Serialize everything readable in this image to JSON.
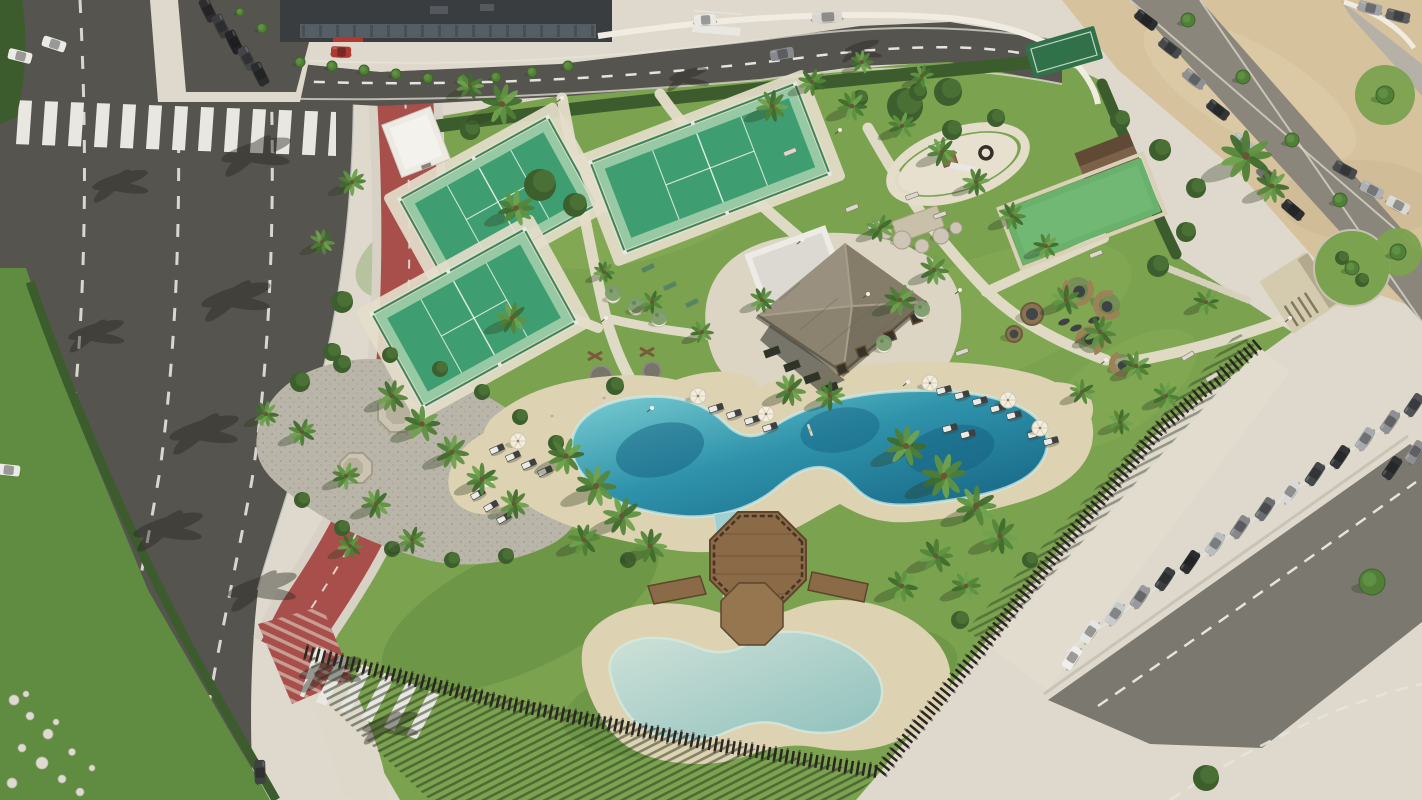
{
  "scene": {
    "description": "Aerial rendering of a fenced resort amenity park: free-form lagoon pool with sand beach and kids pool, octagonal timber deck, thatched-roof pavilion with white annex, three padel courts, playground, petanque court, wicker seating pods, palm landscaping; curved multi-lane road with red bike lane on the left, parking lots on top and right, sand esplanade top-right."
  },
  "palette": {
    "road": "#56544e",
    "roadLight": "#8a867c",
    "parking": "#7b786f",
    "marking": "#e6e4de",
    "bike": "#a84f4c",
    "concrete": "#ded9cc",
    "path": "#e4ddca",
    "beach": "#ddd2b2",
    "sand": "#d6c29d",
    "lawn": "#7ba24f",
    "lawnDark": "#5f8c40",
    "hedge": "#3d5c2e",
    "poolDeep": "#135f80",
    "poolMid": "#2f93ab",
    "poolLight": "#7fd0d4",
    "poolPale": "#abd1cb",
    "poolRim": "#cfe9e4",
    "wood": "#8a6a47",
    "woodDark": "#5e462c",
    "thatch": "#8d8471",
    "fence": "#2b2622",
    "building": "#3a3d40",
    "courtGreen": "#3f9e71",
    "courtLight": "#97c9a5",
    "courtFence": "#2f7a50",
    "white": "#efece4"
  },
  "objects": {
    "courts": [
      {
        "x": 498,
        "y": 202,
        "w": 165,
        "h": 96,
        "a": -29,
        "kind": "padel"
      },
      {
        "x": 474,
        "y": 318,
        "w": 170,
        "h": 102,
        "a": -29,
        "kind": "padel"
      },
      {
        "x": 710,
        "y": 168,
        "w": 215,
        "h": 92,
        "a": -21,
        "kind": "padel"
      },
      {
        "x": 1082,
        "y": 211,
        "w": 148,
        "h": 58,
        "a": -21,
        "kind": "turf"
      },
      {
        "x": 1064,
        "y": 52,
        "w": 72,
        "h": 34,
        "a": -16,
        "kind": "mini"
      }
    ],
    "palms": [
      [
        502,
        104,
        19
      ],
      [
        516,
        208,
        17
      ],
      [
        512,
        318,
        15
      ],
      [
        470,
        86,
        13
      ],
      [
        392,
        396,
        15
      ],
      [
        422,
        424,
        17
      ],
      [
        452,
        452,
        16
      ],
      [
        482,
        479,
        15
      ],
      [
        514,
        504,
        14
      ],
      [
        302,
        432,
        13
      ],
      [
        266,
        414,
        12
      ],
      [
        346,
        476,
        13
      ],
      [
        376,
        504,
        14
      ],
      [
        412,
        540,
        13
      ],
      [
        350,
        546,
        12
      ],
      [
        566,
        456,
        17
      ],
      [
        596,
        486,
        19
      ],
      [
        622,
        516,
        18
      ],
      [
        650,
        546,
        16
      ],
      [
        584,
        540,
        15
      ],
      [
        906,
        446,
        19
      ],
      [
        944,
        476,
        21
      ],
      [
        976,
        506,
        19
      ],
      [
        1000,
        536,
        17
      ],
      [
        936,
        556,
        16
      ],
      [
        902,
        586,
        15
      ],
      [
        966,
        586,
        14
      ],
      [
        790,
        390,
        15
      ],
      [
        830,
        396,
        14
      ],
      [
        762,
        300,
        12
      ],
      [
        900,
        300,
        15
      ],
      [
        934,
        270,
        14
      ],
      [
        880,
        228,
        13
      ],
      [
        772,
        106,
        15
      ],
      [
        812,
        82,
        13
      ],
      [
        852,
        106,
        14
      ],
      [
        902,
        126,
        13
      ],
      [
        942,
        152,
        14
      ],
      [
        976,
        182,
        13
      ],
      [
        1012,
        216,
        13
      ],
      [
        1046,
        246,
        12
      ],
      [
        862,
        62,
        11
      ],
      [
        922,
        76,
        11
      ],
      [
        1066,
        300,
        14
      ],
      [
        1100,
        332,
        15
      ],
      [
        1136,
        366,
        14
      ],
      [
        1166,
        396,
        13
      ],
      [
        1082,
        392,
        12
      ],
      [
        1120,
        422,
        12
      ],
      [
        1246,
        156,
        24
      ],
      [
        1272,
        186,
        16
      ],
      [
        352,
        182,
        13
      ],
      [
        322,
        242,
        12
      ],
      [
        652,
        302,
        11
      ],
      [
        604,
        272,
        10
      ],
      [
        1206,
        302,
        12
      ],
      [
        702,
        332,
        11
      ]
    ],
    "shrubs": [
      [
        540,
        185,
        16
      ],
      [
        575,
        205,
        12
      ],
      [
        905,
        106,
        18
      ],
      [
        948,
        92,
        14
      ],
      [
        615,
        386,
        9
      ],
      [
        1206,
        778,
        13
      ],
      [
        470,
        130,
        10
      ],
      [
        1158,
        266,
        11
      ],
      [
        1186,
        232,
        10
      ],
      [
        342,
        302,
        11
      ],
      [
        332,
        352,
        9
      ],
      [
        1342,
        258,
        7
      ],
      [
        1362,
        280,
        7
      ],
      [
        952,
        130,
        10
      ],
      [
        996,
        118,
        9
      ],
      [
        918,
        92,
        9
      ],
      [
        860,
        98,
        8
      ],
      [
        1120,
        120,
        10
      ],
      [
        1160,
        150,
        11
      ],
      [
        1196,
        188,
        10
      ],
      [
        300,
        382,
        10
      ],
      [
        342,
        364,
        9
      ],
      [
        390,
        355,
        8
      ],
      [
        440,
        369,
        8
      ],
      [
        482,
        392,
        8
      ],
      [
        520,
        417,
        8
      ],
      [
        556,
        443,
        8
      ],
      [
        302,
        500,
        8
      ],
      [
        342,
        528,
        8
      ],
      [
        392,
        549,
        8
      ],
      [
        452,
        560,
        8
      ],
      [
        506,
        556,
        8
      ],
      [
        628,
        560,
        8
      ],
      [
        960,
        620,
        9
      ],
      [
        1030,
        560,
        8
      ]
    ],
    "trees": [
      [
        300,
        62,
        5
      ],
      [
        332,
        66,
        5
      ],
      [
        364,
        70,
        5
      ],
      [
        396,
        74,
        5
      ],
      [
        428,
        78,
        5
      ],
      [
        462,
        80,
        5
      ],
      [
        496,
        77,
        5
      ],
      [
        532,
        72,
        5
      ],
      [
        568,
        66,
        5
      ],
      [
        262,
        28,
        5
      ],
      [
        240,
        12,
        4
      ],
      [
        1188,
        20,
        7
      ],
      [
        1243,
        77,
        7
      ],
      [
        1292,
        140,
        7
      ],
      [
        1340,
        200,
        7
      ],
      [
        1385,
        95,
        9
      ],
      [
        1398,
        252,
        8
      ],
      [
        1372,
        582,
        13
      ],
      [
        1352,
        268,
        7
      ]
    ],
    "cars": [
      {
        "x": 208,
        "y": 10,
        "a": 64,
        "c": "#2e2e30"
      },
      {
        "x": 221,
        "y": 26,
        "a": 64,
        "c": "#3a3c3e"
      },
      {
        "x": 234,
        "y": 42,
        "a": 64,
        "c": "#232426"
      },
      {
        "x": 247,
        "y": 58,
        "a": 64,
        "c": "#434548"
      },
      {
        "x": 260,
        "y": 74,
        "a": 64,
        "c": "#2b2c2e"
      },
      {
        "x": 54,
        "y": 44,
        "a": 18,
        "c": "#e9e9e5"
      },
      {
        "x": 20,
        "y": 56,
        "a": 14,
        "c": "#eceae6"
      },
      {
        "x": 8,
        "y": 470,
        "a": 6,
        "c": "#eceae6"
      },
      {
        "x": 260,
        "y": 772,
        "a": 88,
        "c": "#3f4143"
      },
      {
        "x": 705,
        "y": 20,
        "a": -4,
        "c": "#e9e8e4",
        "l": 22
      },
      {
        "x": 827,
        "y": 17,
        "a": -3,
        "c": "#d9d6cf",
        "l": 30
      },
      {
        "x": 782,
        "y": 54,
        "a": -10,
        "c": "#87898c"
      },
      {
        "x": 341,
        "y": 52,
        "a": 2,
        "c": "#b23730",
        "l": 20
      },
      {
        "x": 1146,
        "y": 20,
        "a": 38,
        "c": "#2c2d2f"
      },
      {
        "x": 1170,
        "y": 48,
        "a": 38,
        "c": "#47494c"
      },
      {
        "x": 1194,
        "y": 79,
        "a": 38,
        "c": "#8e9092"
      },
      {
        "x": 1218,
        "y": 110,
        "a": 38,
        "c": "#333538"
      },
      {
        "x": 1243,
        "y": 143,
        "a": 39,
        "c": "#b9bbbd"
      },
      {
        "x": 1268,
        "y": 176,
        "a": 39,
        "c": "#6f7173"
      },
      {
        "x": 1293,
        "y": 210,
        "a": 40,
        "c": "#2e2f31"
      },
      {
        "x": 1345,
        "y": 170,
        "a": 28,
        "c": "#48494b"
      },
      {
        "x": 1372,
        "y": 190,
        "a": 28,
        "c": "#aeb0b2"
      },
      {
        "x": 1398,
        "y": 205,
        "a": 28,
        "c": "#d8d8d6"
      },
      {
        "x": 1398,
        "y": 16,
        "a": 14,
        "c": "#5a5c5e"
      },
      {
        "x": 1370,
        "y": 8,
        "a": 14,
        "c": "#a0a2a4"
      },
      {
        "x": 1090,
        "y": 632,
        "a": -56,
        "c": "#e5e5e3"
      },
      {
        "x": 1115,
        "y": 614,
        "a": -56,
        "c": "#c8c9cb"
      },
      {
        "x": 1140,
        "y": 597,
        "a": -56,
        "c": "#97999c"
      },
      {
        "x": 1165,
        "y": 579,
        "a": -56,
        "c": "#3c3e40"
      },
      {
        "x": 1190,
        "y": 562,
        "a": -56,
        "c": "#2b2c2e"
      },
      {
        "x": 1215,
        "y": 544,
        "a": -56,
        "c": "#babcbe"
      },
      {
        "x": 1240,
        "y": 527,
        "a": -56,
        "c": "#85878a"
      },
      {
        "x": 1265,
        "y": 509,
        "a": -56,
        "c": "#6b6d70"
      },
      {
        "x": 1290,
        "y": 492,
        "a": -56,
        "c": "#d9d9d7"
      },
      {
        "x": 1315,
        "y": 474,
        "a": -56,
        "c": "#45474a"
      },
      {
        "x": 1340,
        "y": 457,
        "a": -56,
        "c": "#333537"
      },
      {
        "x": 1365,
        "y": 439,
        "a": -56,
        "c": "#a7a9ac"
      },
      {
        "x": 1390,
        "y": 422,
        "a": -56,
        "c": "#8e9093"
      },
      {
        "x": 1414,
        "y": 405,
        "a": -56,
        "c": "#505254"
      },
      {
        "x": 1072,
        "y": 658,
        "a": -56,
        "c": "#efeeea"
      },
      {
        "x": 1392,
        "y": 468,
        "a": -56,
        "c": "#303234"
      },
      {
        "x": 1415,
        "y": 452,
        "a": -56,
        "c": "#8d8f92"
      }
    ],
    "loungers": [
      [
        716,
        408,
        -18
      ],
      [
        734,
        414,
        -18
      ],
      [
        752,
        420,
        -18
      ],
      [
        770,
        427,
        -18
      ],
      [
        944,
        390,
        -15
      ],
      [
        962,
        395,
        -15
      ],
      [
        980,
        401,
        -15
      ],
      [
        998,
        408,
        -15
      ],
      [
        1014,
        415,
        -15
      ],
      [
        950,
        428,
        -15
      ],
      [
        968,
        434,
        -15
      ],
      [
        497,
        449,
        -24
      ],
      [
        513,
        456,
        -24
      ],
      [
        529,
        464,
        -24
      ],
      [
        545,
        471,
        -24
      ],
      [
        478,
        494,
        -30
      ],
      [
        491,
        506,
        -30
      ],
      [
        504,
        518,
        -30
      ],
      [
        1035,
        434,
        -15
      ],
      [
        1051,
        441,
        -15
      ]
    ],
    "umbrellas_open": [
      [
        698,
        396
      ],
      [
        766,
        414
      ],
      [
        930,
        383
      ],
      [
        1008,
        400
      ],
      [
        1040,
        428
      ],
      [
        518,
        441
      ],
      [
        486,
        480
      ]
    ],
    "umbrellas_closed": [
      [
        810,
        430
      ],
      [
        604,
        398
      ],
      [
        552,
        416
      ]
    ],
    "pods": [
      {
        "x": 1032,
        "y": 314,
        "r": 11,
        "t": "o"
      },
      {
        "x": 1078,
        "y": 290,
        "r": 13,
        "t": "c",
        "a": -40
      },
      {
        "x": 1108,
        "y": 305,
        "r": 12,
        "t": "c",
        "a": 30
      },
      {
        "x": 1090,
        "y": 341,
        "r": 12,
        "t": "c",
        "a": 170
      },
      {
        "x": 1122,
        "y": 364,
        "r": 10,
        "t": "c",
        "a": -10
      },
      {
        "x": 1014,
        "y": 334,
        "r": 8,
        "t": "o"
      }
    ],
    "cushions": [
      [
        1064,
        322
      ],
      [
        1076,
        328
      ],
      [
        1094,
        320
      ]
    ],
    "planters": [
      [
        613,
        296
      ],
      [
        636,
        308
      ],
      [
        659,
        320
      ],
      [
        884,
        346
      ],
      [
        922,
        312
      ]
    ],
    "benches": [
      [
        648,
        268,
        -25,
        "g"
      ],
      [
        670,
        286,
        -25,
        "g"
      ],
      [
        692,
        303,
        -25,
        "g"
      ],
      [
        852,
        208,
        -22,
        ""
      ],
      [
        874,
        225,
        -22,
        ""
      ],
      [
        912,
        196,
        -20,
        ""
      ],
      [
        940,
        215,
        -20,
        ""
      ],
      [
        1096,
        254,
        -21,
        ""
      ],
      [
        1188,
        356,
        -30,
        ""
      ],
      [
        1212,
        377,
        -30,
        ""
      ],
      [
        962,
        352,
        -20,
        ""
      ],
      [
        790,
        152,
        -22,
        ""
      ]
    ],
    "tables": [
      [
        862,
        352
      ],
      [
        890,
        336
      ],
      [
        916,
        318
      ],
      [
        842,
        369
      ],
      [
        898,
        300
      ]
    ],
    "boulders": [
      [
        902,
        240,
        9
      ],
      [
        922,
        246,
        7
      ],
      [
        941,
        236,
        8
      ],
      [
        886,
        233,
        6
      ],
      [
        956,
        228,
        6
      ]
    ],
    "rocks": [
      [
        14,
        700,
        5
      ],
      [
        30,
        716,
        4
      ],
      [
        48,
        734,
        5
      ],
      [
        22,
        748,
        4
      ],
      [
        42,
        763,
        6
      ],
      [
        62,
        779,
        4
      ],
      [
        12,
        783,
        5
      ],
      [
        72,
        752,
        3.5
      ],
      [
        56,
        722,
        3
      ],
      [
        80,
        792,
        4
      ],
      [
        92,
        768,
        3
      ],
      [
        26,
        694,
        3
      ]
    ],
    "road_shadows": [
      [
        256,
        150,
        1
      ],
      [
        236,
        295,
        1
      ],
      [
        204,
        428,
        1
      ],
      [
        168,
        525,
        1
      ],
      [
        262,
        585,
        1
      ],
      [
        330,
        668,
        0.9
      ],
      [
        390,
        722,
        0.8
      ],
      [
        688,
        74,
        0.55
      ],
      [
        862,
        46,
        0.5
      ],
      [
        120,
        180,
        0.8
      ],
      [
        96,
        330,
        0.8
      ]
    ],
    "light_posts": [
      [
        652,
        408
      ],
      [
        802,
        240
      ],
      [
        868,
        294
      ],
      [
        908,
        382
      ],
      [
        606,
        318
      ],
      [
        1106,
        360
      ],
      [
        1290,
        318
      ],
      [
        562,
        98
      ],
      [
        840,
        130
      ],
      [
        960,
        290
      ]
    ]
  }
}
